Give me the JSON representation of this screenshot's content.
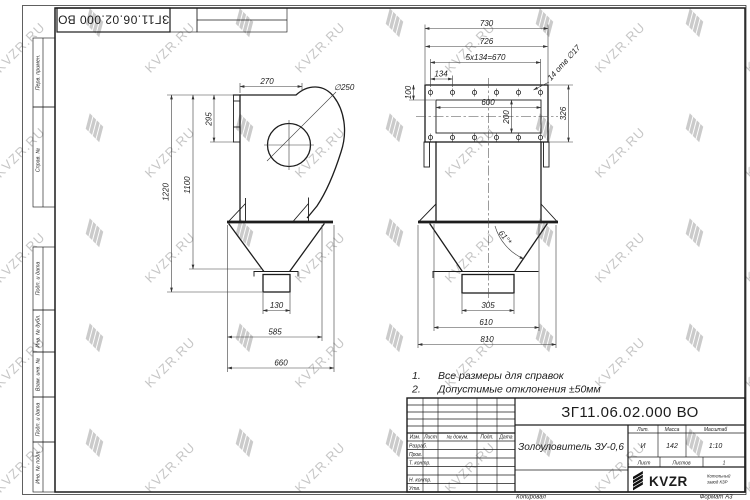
{
  "watermark": {
    "text": "KVZR.RU",
    "color": "#c6c6c6"
  },
  "sheet": {
    "top_designation": "ЗГ11.06.02.000 ВО",
    "margin_labels": {
      "perv": "Перв. примен.",
      "sprav": "Справ. №",
      "podp1": "Подп. и дата",
      "inv_dubl": "Инв. № дубл.",
      "vzam": "Взам. инв. №",
      "podp2": "Подп. и дата",
      "inv_podl": "Инв. № подл."
    },
    "copied_label": "Копировал",
    "format_label": "Формат А3"
  },
  "left_view": {
    "dims": {
      "w270": "270",
      "h295": "295",
      "h1220": "1220",
      "h1100": "1100",
      "dia": "∅250",
      "w130": "130",
      "w585": "585",
      "w660": "660"
    }
  },
  "right_view": {
    "dims": {
      "w730": "730",
      "w726": "726",
      "pitch": "5x134=670",
      "w134": "134",
      "h100": "100",
      "w600": "600",
      "h200": "200",
      "h326": "326",
      "holes": "14 отв ∅17",
      "w305": "305",
      "w610": "610",
      "w810": "810",
      "angle": "61°*"
    }
  },
  "notes": {
    "items": [
      {
        "num": "1.",
        "text": "Все размеры для справок"
      },
      {
        "num": "2.",
        "text": "Допустимые отклонения ±50мм"
      }
    ]
  },
  "title_block": {
    "designation": "ЗГ11.06.02.000 ВО",
    "name": "Золоуловитель ЗУ-0,6",
    "headers": {
      "izm": "Изм.",
      "list": "Лист",
      "doc": "№ докум.",
      "podp": "Подп.",
      "data": "Дата"
    },
    "rows": {
      "razrab": "Разраб.",
      "prov": "Пров.",
      "tkontr": "Т. контр.",
      "nkontr": "Н. контр.",
      "utv": "Утв."
    },
    "lit_label": "Лит.",
    "massa_label": "Масса",
    "masshtab_label": "Масштаб",
    "lit": "И",
    "massa": "142",
    "masshtab": "1:10",
    "list_label": "Лист",
    "listov_label": "Листов",
    "listov": "1",
    "brand": "KVZR",
    "brand_sub1": "Котельный",
    "brand_sub2": "завод КЗР"
  }
}
